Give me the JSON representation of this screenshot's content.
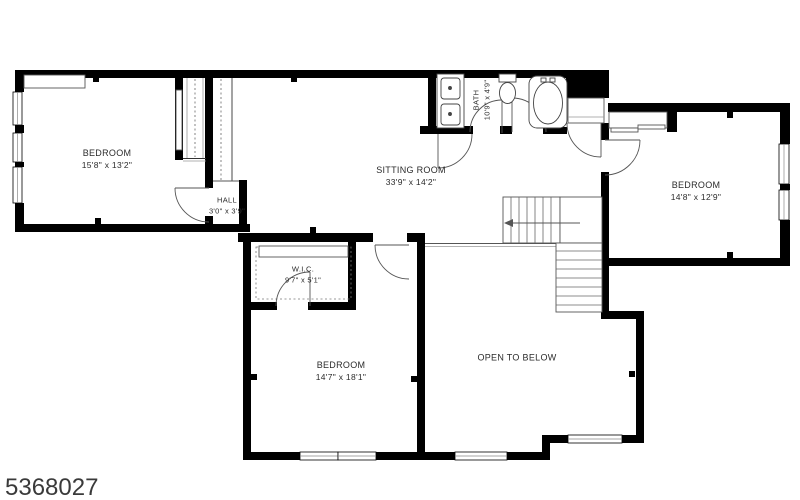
{
  "plan": {
    "listing_id": "5368027",
    "rooms": [
      {
        "id": "bedroom-left",
        "name": "BEDROOM",
        "dims": "15'8\" x 13'2\""
      },
      {
        "id": "hall",
        "name": "HALL",
        "dims": "3'0\" x 3'9\""
      },
      {
        "id": "sitting-room",
        "name": "SITTING ROOM",
        "dims": "33'9\" x 14'2\""
      },
      {
        "id": "bath",
        "name": "BATH",
        "dims": "10'9\" x 4'9\""
      },
      {
        "id": "bedroom-right",
        "name": "BEDROOM",
        "dims": "14'8\" x 12'9\""
      },
      {
        "id": "wic",
        "name": "W.I.C.",
        "dims": "9'7\" x 5'1\""
      },
      {
        "id": "bedroom-bottom",
        "name": "BEDROOM",
        "dims": "14'7\" x 18'1\""
      },
      {
        "id": "open-to-below",
        "name": "OPEN TO BELOW",
        "dims": ""
      }
    ],
    "colors": {
      "walls": "#000000",
      "background": "#ffffff",
      "labels": "#2b2b2b"
    }
  }
}
